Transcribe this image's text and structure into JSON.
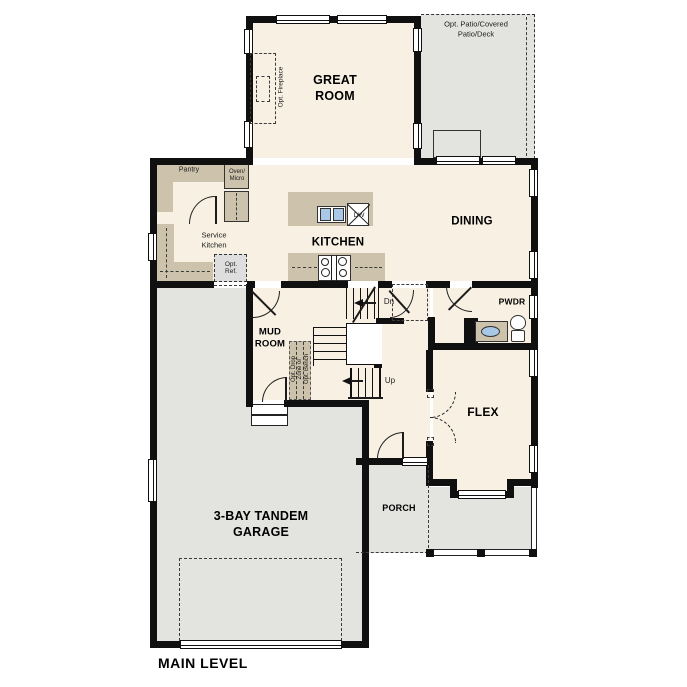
{
  "plan_title": "MAIN LEVEL",
  "rooms": {
    "great_room": "GREAT\nROOM",
    "kitchen": "KITCHEN",
    "dining": "DINING",
    "pwdr": "PWDR",
    "mud_room": "MUD\nROOM",
    "flex": "FLEX",
    "porch": "PORCH",
    "garage": "3-BAY TANDEM\nGARAGE"
  },
  "annotations": {
    "opt_patio": "Opt. Patio/Covered\nPatio/Deck",
    "opt_fireplace": "Opt. Fireplace",
    "pantry": "Pantry",
    "oven_micro": "Oven/\nMicro",
    "service_kitchen": "Service\nKitchen",
    "opt_ref": "Opt.\nRef.",
    "dishwasher": "DW",
    "stairs_down": "Dn",
    "stairs_up": "Up",
    "opt_drop_1": "Opt. Drop",
    "opt_drop_2": "Zone or",
    "opt_drop_3": "Opt. Bench"
  },
  "colors": {
    "floor_cream": "#f8f1e3",
    "cabinet_tan": "#cdc2ac",
    "exterior_gray": "#e3e3e0",
    "wall_black": "#101010",
    "sink_blue": "#a9c8e8"
  }
}
